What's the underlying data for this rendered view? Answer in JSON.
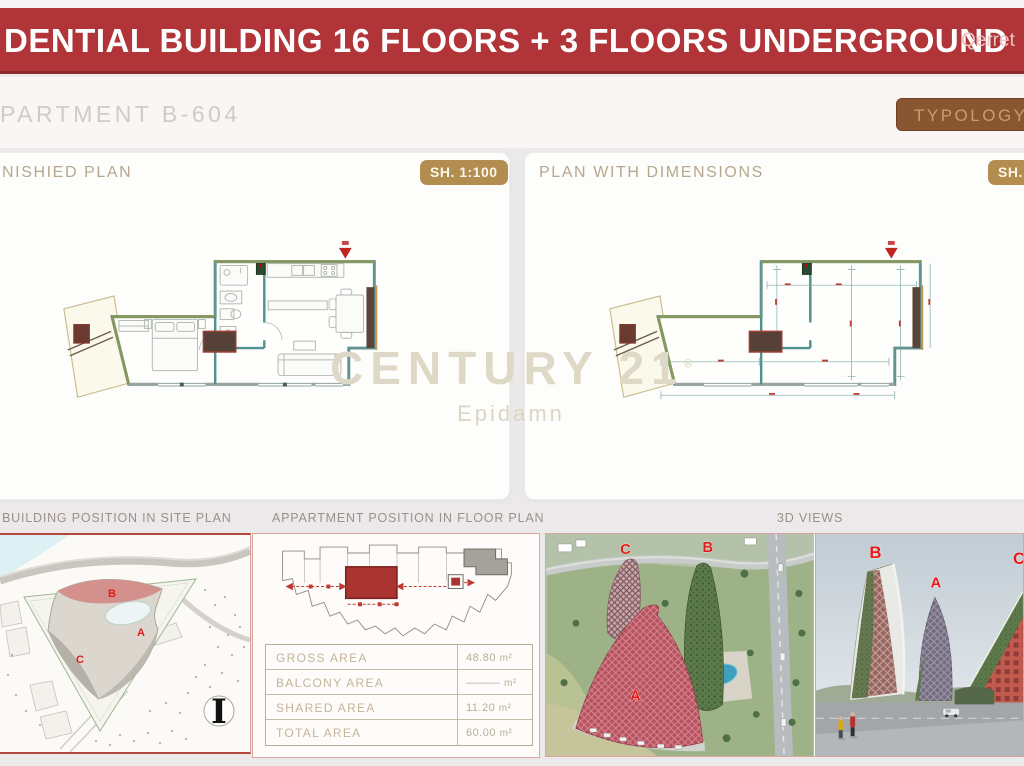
{
  "header": {
    "title": "DENTIAL BUILDING 16 FLOORS + 3 FLOORS UNDERGROUND",
    "location": "Qerret"
  },
  "apartment": {
    "title": "PARTMENT B-604",
    "typology_badge": "TYPOLOGY 1"
  },
  "plans": {
    "furnished": {
      "title": "NISHIED PLAN",
      "scale_badge": "SH. 1:100"
    },
    "dimensioned": {
      "title": "PLAN WITH DIMENSIONS",
      "scale_badge": "SH."
    }
  },
  "watermark": {
    "brand": "CENTURY 21",
    "reg": "®",
    "sub_brand": "Epidamn"
  },
  "bottom": {
    "site_plan_title": "BUILDING POSITION IN SITE PLAN",
    "floor_position_title": "APPARTMENT POSITION IN FLOOR PLAN",
    "views_title": "3D VIEWS"
  },
  "site_plan": {
    "label_a": "A",
    "label_b": "B",
    "label_c": "C",
    "north_mark": "I"
  },
  "area_table": {
    "rows": [
      {
        "label": "GROSS AREA",
        "value": "48.80",
        "unit": "m²"
      },
      {
        "label": "BALCONY AREA",
        "value": "———",
        "unit": "m²"
      },
      {
        "label": "SHARED AREA",
        "value": "11.20",
        "unit": "m²"
      },
      {
        "label": "TOTAL AREA",
        "value": "60.00",
        "unit": "m²"
      }
    ]
  },
  "aerial_view": {
    "label_a": "A",
    "label_b": "B",
    "label_c": "C"
  },
  "street_view": {
    "label_a": "A",
    "label_b": "B",
    "label_c": "C"
  },
  "colors": {
    "banner_red": "#b13538",
    "badge_brown": "#8a5531",
    "badge_gold": "#b28d4f",
    "accent_red_label": "#e41a1a",
    "panel_border_pink": "#dba49e"
  }
}
